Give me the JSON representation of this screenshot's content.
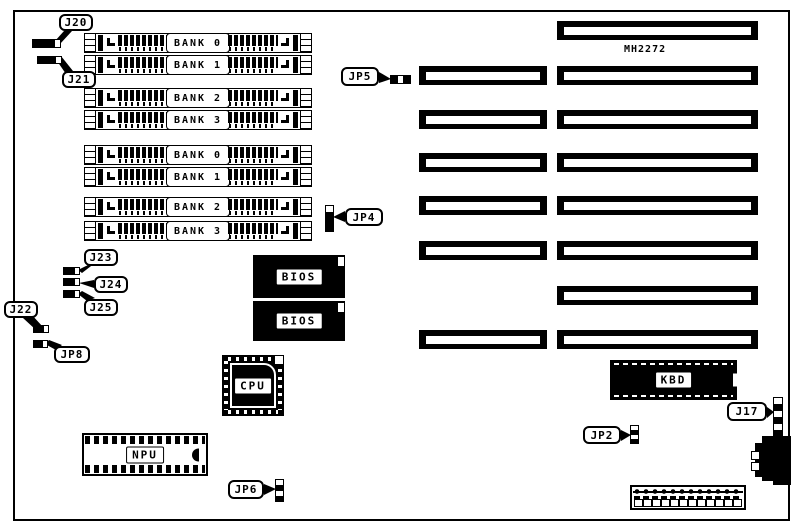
{
  "colors": {
    "ink": "#000000",
    "paper": "#ffffff"
  },
  "board": {
    "model_label": "MH2272"
  },
  "memory_banks": [
    "BANK 0",
    "BANK 1",
    "BANK 2",
    "BANK 3",
    "BANK 0",
    "BANK 1",
    "BANK 2",
    "BANK 3"
  ],
  "chips": {
    "bios_top": "BIOS",
    "bios_bottom": "BIOS",
    "cpu": "CPU",
    "npu": "NPU",
    "kbd": "KBD"
  },
  "callouts": {
    "j20": "J20",
    "j21": "J21",
    "j22": "J22",
    "j23": "J23",
    "j24": "J24",
    "j25": "J25",
    "jp2": "JP2",
    "jp4": "JP4",
    "jp5": "JP5",
    "jp6": "JP6",
    "jp8": "JP8",
    "j17": "J17"
  }
}
